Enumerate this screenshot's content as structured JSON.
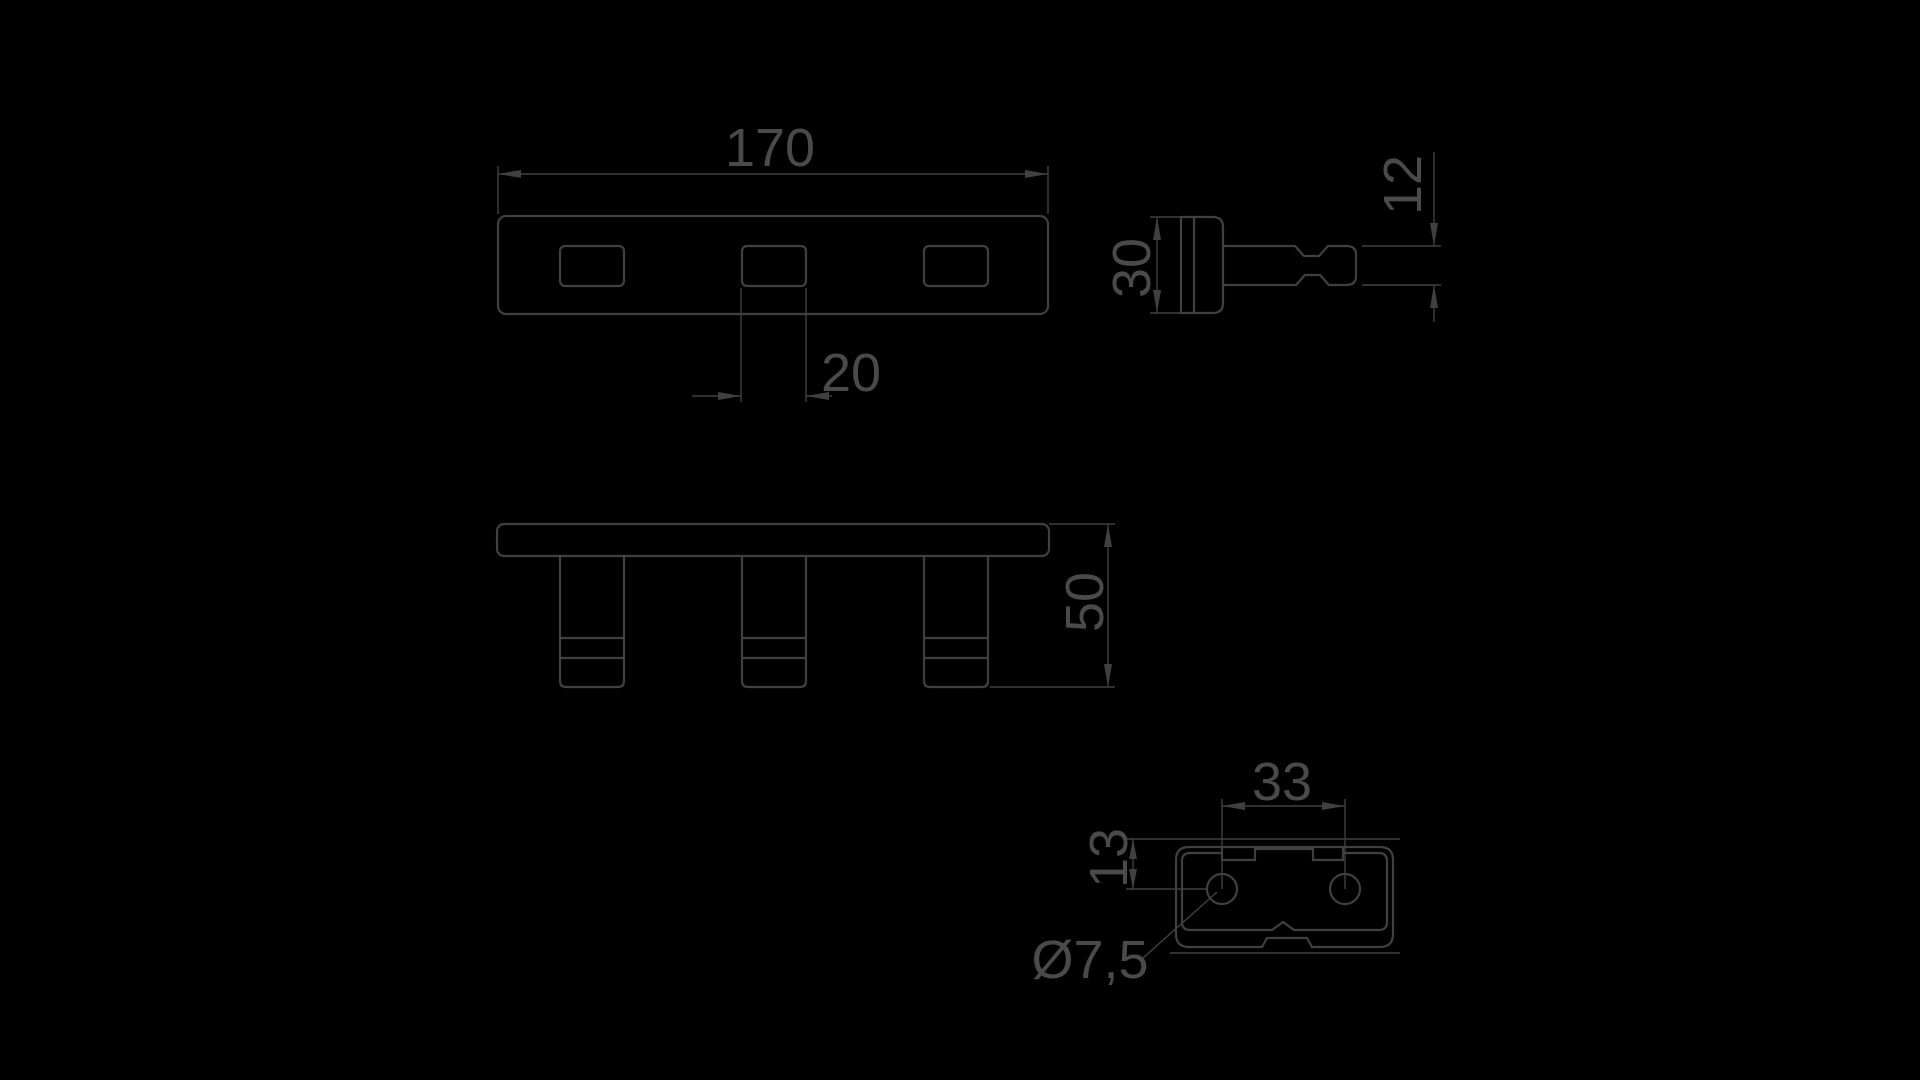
{
  "drawing": {
    "type": "technical-dimension-drawing",
    "part": "slotted mounting bracket",
    "views": {
      "top_view": "plate with three slots",
      "side_view": "profile with stem and neck",
      "front_view": "bar with three hooks",
      "detail_view": "base plate with two holes"
    }
  },
  "colors": {
    "background": "#000000",
    "ink": "#404040",
    "text": "#4d4d4d"
  },
  "dimensions": {
    "plate_length": "170",
    "slot_width": "20",
    "profile_height": "30",
    "stem_height": "12",
    "overall_height": "50",
    "hole_spacing": "33",
    "hole_offset": "13",
    "hole_diameter": "Ø7,5"
  }
}
